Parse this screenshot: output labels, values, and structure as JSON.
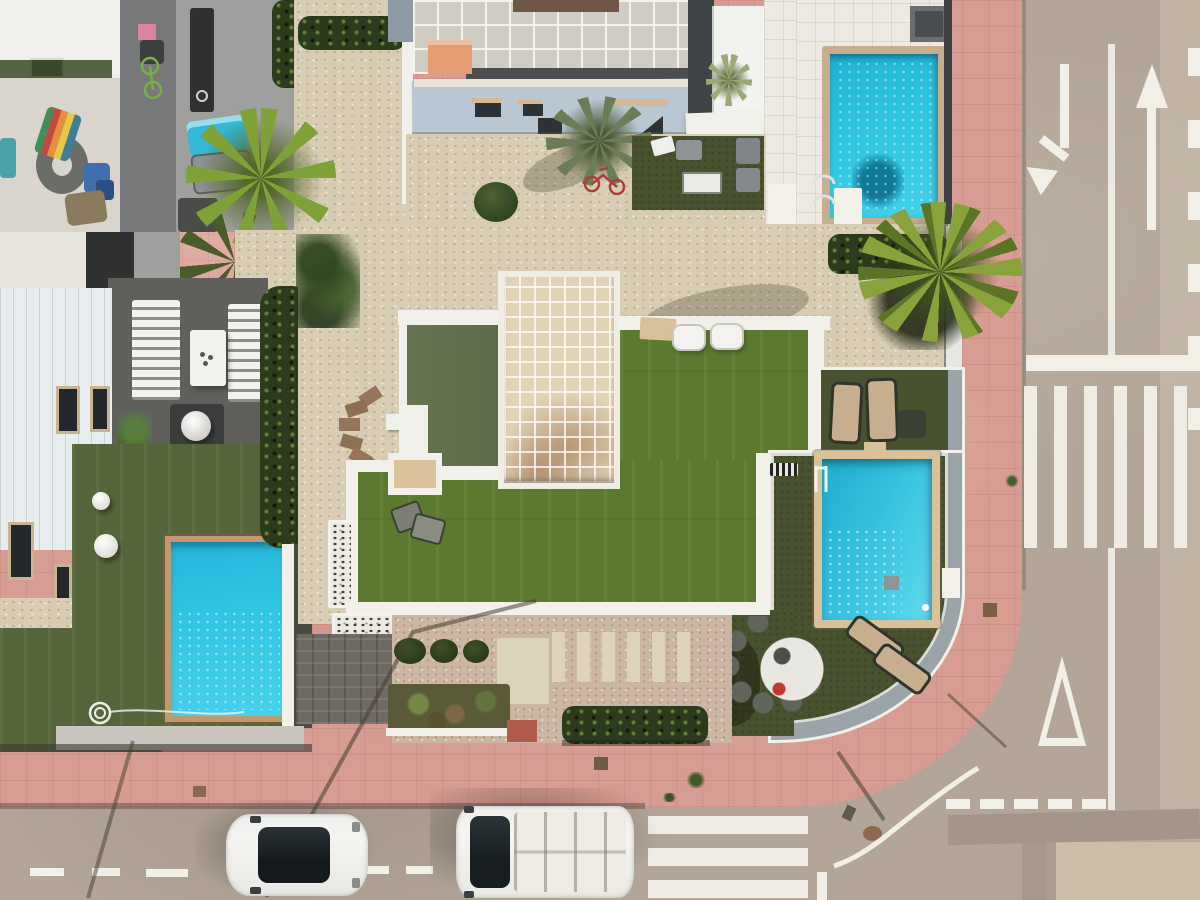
{
  "scene": {
    "type": "aerial-drone-photo",
    "subject": "residential villas with pools at a street corner",
    "visible_text": "none",
    "objects": [
      "main-villa-flat-roof-olive",
      "main-villa-tiled-terrace",
      "main-villa-artificial-lawn",
      "main-pool",
      "pool-dining-set",
      "sun-loungers-tan",
      "sun-loungers-white",
      "left-villa",
      "left-villa-pool",
      "left-villa-lawn",
      "garden-sphere-lights",
      "garden-hose-coil",
      "top-villa-tiled-roof",
      "top-villa-facade",
      "orange-awning",
      "neighbor-pool-top-right",
      "palm-trees",
      "hedges",
      "gravel-yards",
      "pink-sidewalk",
      "street-corner",
      "white-hatchback-car",
      "white-van",
      "street-lamp-shadows"
    ],
    "road_markings": [
      "left-turn-arrow",
      "straight-arrow",
      "lane-divider-line",
      "stop-bar",
      "zebra-crosswalk-right",
      "zebra-crosswalk-bottom",
      "give-way-triangle",
      "dashed-center-line-bottom",
      "corner-edge-arc",
      "edge-block-markings-right"
    ]
  },
  "palette": {
    "road": "#b3a698",
    "roadDark": "#a3958a",
    "concrete": "#cbbda8",
    "pink": "#d79c92",
    "white": "#f2efe6",
    "wallWhite": "#f2f0ea",
    "wallGray": "#9aa4a9",
    "charcoal": "#3e4244",
    "gravelCream": "#d8ccb2",
    "gravelPink": "#ccb5a3",
    "turfBright": "#5b7a30",
    "turfOlive": "#566539",
    "turfDeck": "#49522e",
    "hedge": "#2c3b1c",
    "oliveRoof": "#5f6c4b",
    "tileCream": "#e2d2b6",
    "poolCyan": "#2ec1dd",
    "poolDeep": "#1fa5c8",
    "coping": "#d9c299",
    "copingTan": "#c6ae8e",
    "facadeBlue": "#b9c7d2",
    "awning": "#e59c72",
    "patioDark": "#5f605c",
    "carWhite": "#f5f4f0",
    "glassDark": "#1d2326"
  }
}
